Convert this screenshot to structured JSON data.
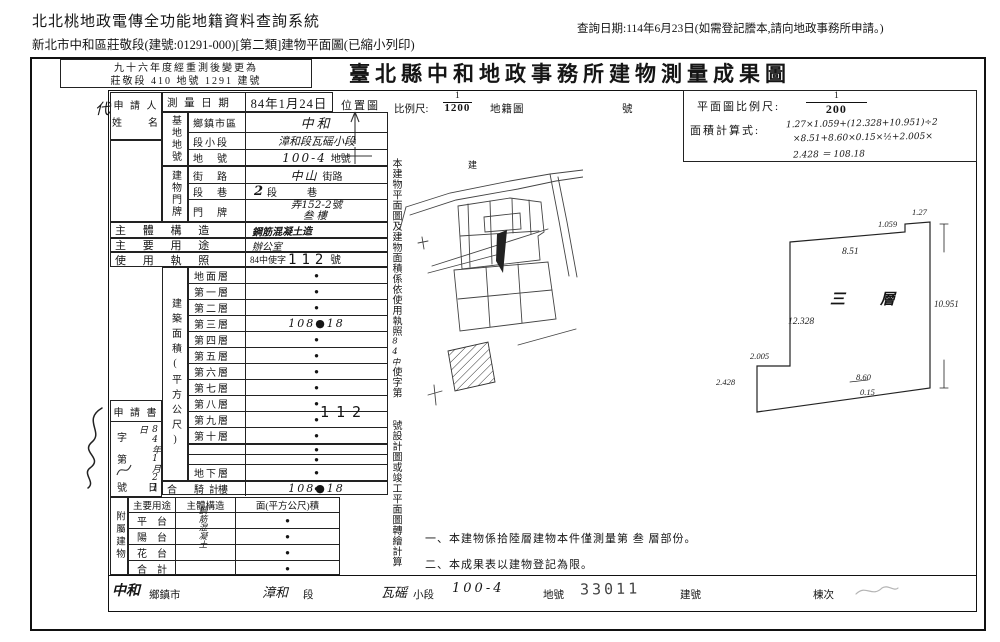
{
  "colors": {
    "ink": "#1b1b1b",
    "paper": "#ffffff"
  },
  "header": {
    "system_title": "北北桃地政電傳全功能地籍資料查詢系統",
    "subtitle": "新北市中和區莊敬段(建號:01291-000)[第二類]建物平面圖(已縮小列印)",
    "query_date": "查詢日期:114年6月23日(如需登記謄本,請向地政事務所申請。)"
  },
  "document": {
    "remeasure_line1": "九十六年度經重測後變更為",
    "remeasure_line2": "莊敬段 410 地號 1291 建號",
    "title": "臺北縣中和地政事務所建物測量成果圖",
    "agent_mark": "代",
    "applicant_label_1": "申 請 人",
    "applicant_label_2": "姓　　名",
    "survey_date_label": "測 量 日 期",
    "survey_date_value": "84年1月24日",
    "base": {
      "group_label": "基地地號",
      "rows": [
        {
          "label": "鄉鎮市區",
          "hand": "中和",
          "print": ""
        },
        {
          "label": "段小段",
          "hand": "漳和段瓦磘小段",
          "print": ""
        },
        {
          "label": "地　號",
          "hand": "100-4",
          "print": "地號"
        }
      ]
    },
    "door": {
      "group_label": "建物門牌",
      "rows": [
        {
          "label": "街　路",
          "hand": "中山",
          "print": "街路"
        },
        {
          "label": "段　巷",
          "hand": "2",
          "print": "段　　　巷"
        },
        {
          "label": "門　牌",
          "hand": "弄152-2號",
          "print": ""
        }
      ],
      "floor_value": "叁樓"
    },
    "structure_label": "主 體 構 造",
    "structure_value": "鋼筋混凝土造",
    "usage_label": "主 要 用 途",
    "usage_value": "辦公室",
    "license_label": "使 用 執 照",
    "license_prefix": "84中使字",
    "license_number": "112",
    "license_suffix": "號",
    "area_group_label": "建築面積(平方公尺)",
    "floors": [
      {
        "label": "地面層",
        "value": "●"
      },
      {
        "label": "第一層",
        "value": "●"
      },
      {
        "label": "第二層",
        "value": "●"
      },
      {
        "label": "第三層",
        "value": "108●18"
      },
      {
        "label": "第四層",
        "value": "●"
      },
      {
        "label": "第五層",
        "value": "●"
      },
      {
        "label": "第六層",
        "value": "●"
      },
      {
        "label": "第七層",
        "value": "●"
      },
      {
        "label": "第八層",
        "value": "●"
      },
      {
        "label": "第九層",
        "value": "●"
      },
      {
        "label": "第十層",
        "value": "●"
      },
      {
        "label": "",
        "value": ""
      },
      {
        "label": "",
        "value": "●"
      },
      {
        "label": "",
        "value": "●"
      },
      {
        "label": "地下層",
        "value": "●"
      },
      {
        "label": "騎　樓",
        "value": "●"
      }
    ],
    "total_label": "合　　計",
    "total_value": "108●18",
    "application": {
      "box_label": "申 請 書",
      "char_label": "字",
      "no_label": "第",
      "hand_date": "84年1月21日",
      "number_label": "號",
      "day_label": "日"
    },
    "annex": {
      "group_label": "附屬建物",
      "headers": [
        "主要用途",
        "主體構造",
        "面(平方公尺)積"
      ],
      "structure_value": "鋼筋混凝土",
      "rows": [
        {
          "label": "平　台",
          "value": "●"
        },
        {
          "label": "陽　台",
          "value": "●"
        },
        {
          "label": "花　台",
          "value": "●"
        },
        {
          "label": "合　計",
          "value": "●"
        }
      ]
    },
    "side_note": {
      "part1": "本建物平面圖及建物面積係依使用執照",
      "hand": "84中",
      "part2": "使字第",
      "number": "112",
      "part3": "號設計圖或竣工平面圖轉繪計算"
    },
    "location": {
      "label": "位置圖",
      "scale_label": "比例尺:",
      "scale_num": "1",
      "scale_den": "1200",
      "cadastre_label": "地籍圖",
      "sheet_label": "號",
      "sketch_label": "建"
    },
    "plan": {
      "scale_label": "平面圖比例尺:",
      "scale_num": "1",
      "scale_den": "200",
      "formula_label": "面積計算式:",
      "formula_line1": "1.27×1.059+(12.328+10.951)÷2",
      "formula_line2": "×8.51+8.60×0.15×½+2.005×",
      "formula_line3": "2.428 ＝ 108.18",
      "floor_label": "三　層",
      "dims": {
        "a": "1.27",
        "b": "1.059",
        "c": "8.51",
        "d": "10.951",
        "e": "12.328",
        "f": "2.005",
        "g": "2.428",
        "h": "8.60",
        "i": "0.15"
      }
    },
    "notes": {
      "note1": "一、本建物係拾陸層建物本件僅測量第 叁 層部份。",
      "note2": "二、本成果表以建物登記為限。"
    },
    "footer": {
      "town_hand": "中和",
      "town_label": "鄉鎮市",
      "section_hand": "漳和",
      "section_label": "段",
      "subsection_hand": "瓦磘",
      "subsection_label": "小段",
      "parcel_hand": "100-4",
      "parcel_label": "地號",
      "stamp_number": "33011",
      "building_no_label": "建號",
      "unit_label": "棟次"
    }
  }
}
